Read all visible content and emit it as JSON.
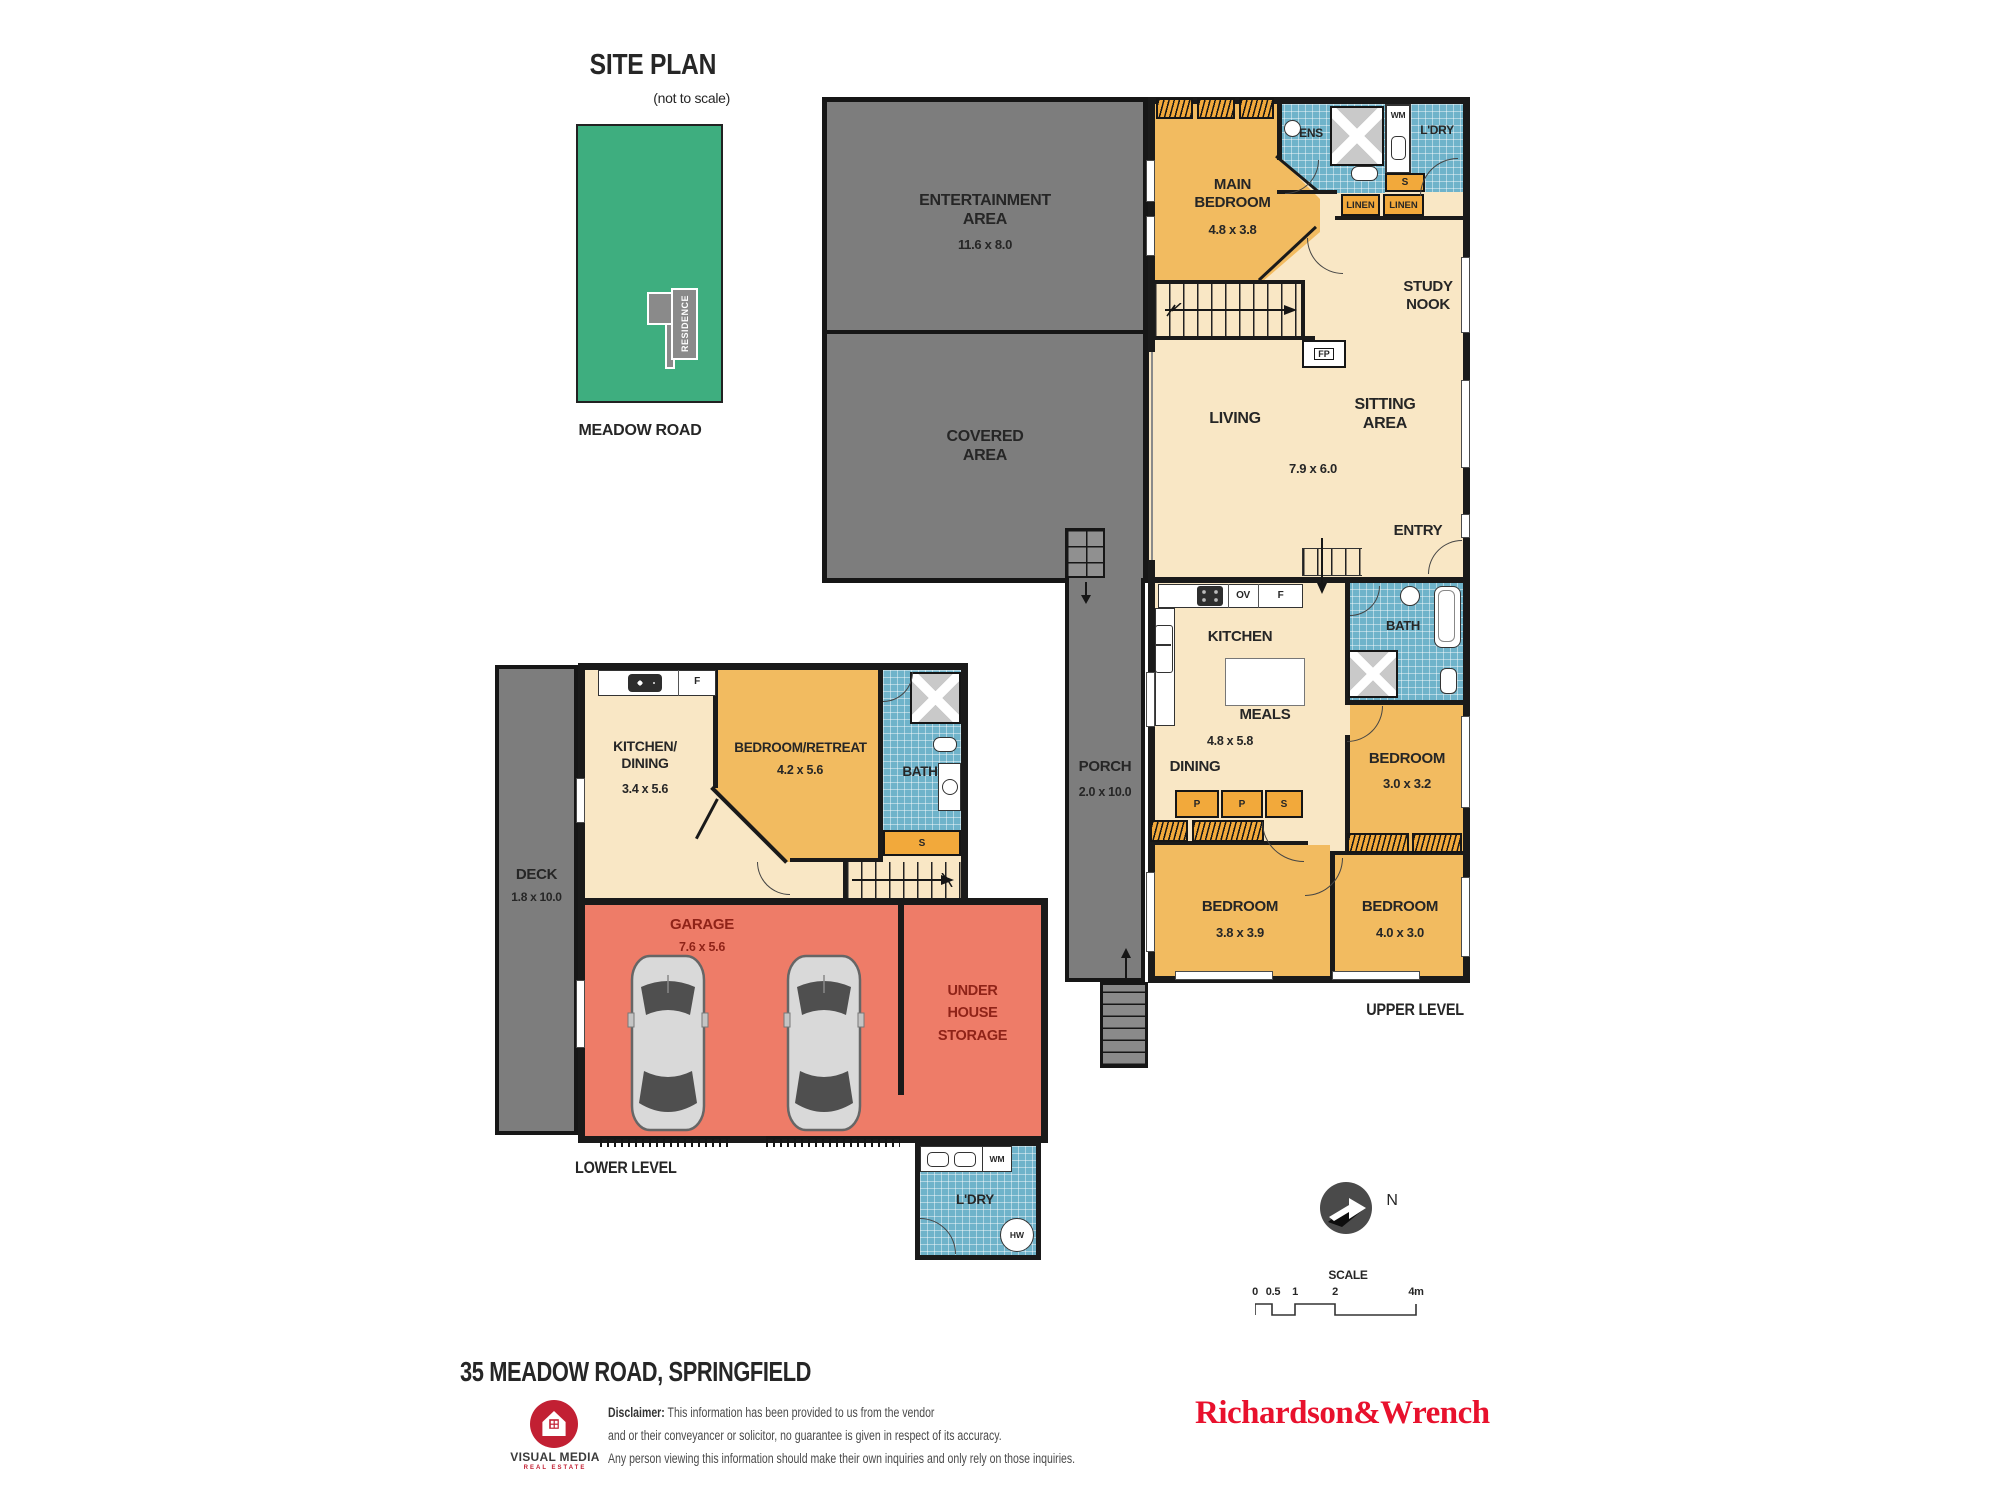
{
  "site_plan": {
    "title": "SITE PLAN",
    "subtitle": "(not to scale)",
    "residence": "RESIDENCE",
    "road": "MEADOW ROAD"
  },
  "upper": {
    "entertainment_name": "ENTERTAINMENT AREA",
    "entertainment_dims": "11.6 x 8.0",
    "covered_name": "COVERED AREA",
    "porch_name": "PORCH",
    "porch_dims": "2.0 x 10.0",
    "main_bedroom_name": "MAIN BEDROOM",
    "main_bedroom_dims": "4.8 x 3.8",
    "ens": "ENS",
    "wm": "WM",
    "ldry": "L'DRY",
    "store_s": "S",
    "linen": [
      "LINEN",
      "LINEN"
    ],
    "study_nook": "STUDY NOOK",
    "fireplace": "FP",
    "living": "LIVING",
    "sitting": "SITTING AREA",
    "living_dims": "7.9 x 6.0",
    "entry": "ENTRY",
    "kitchen": "KITCHEN",
    "oven": "OV",
    "fridge": "F",
    "meals": "MEALS",
    "meals_dims": "4.8 x 5.8",
    "dining": "DINING",
    "pantry": [
      "P",
      "P",
      "S"
    ],
    "bath": "BATH",
    "bedroom1_name": "BEDROOM",
    "bedroom1_dims": "3.0 x 3.2",
    "bedroom2_name": "BEDROOM",
    "bedroom2_dims": "3.8 x 3.9",
    "bedroom3_name": "BEDROOM",
    "bedroom3_dims": "4.0 x 3.0",
    "level": "UPPER LEVEL"
  },
  "lower": {
    "deck_name": "DECK",
    "deck_dims": "1.8 x 10.0",
    "kitchen_name": "KITCHEN/ DINING",
    "kitchen_dims": "3.4 x 5.6",
    "fridge": "F",
    "retreat_name": "BEDROOM/RETREAT",
    "retreat_dims": "4.2 x 5.6",
    "bath": "BATH",
    "store_s": "S",
    "garage_name": "GARAGE",
    "garage_dims": "7.6 x 5.6",
    "storage_name": "UNDER HOUSE STORAGE",
    "ldry": "L'DRY",
    "wm": "WM",
    "hw": "HW",
    "level": "LOWER LEVEL"
  },
  "compass_label": "N",
  "scale_bar": {
    "title": "SCALE",
    "ticks": [
      "0",
      "0.5",
      "1",
      "2",
      "4m"
    ]
  },
  "footer": {
    "address": "35 MEADOW ROAD, SPRINGFIELD",
    "logo_name": "VISUAL MEDIA",
    "logo_tagline": "REAL ESTATE",
    "disclaimer_label": "Disclaimer:",
    "disclaimer_lines": [
      "This information has been provided to us from the vendor",
      "and or their conveyancer or solicitor, no guarantee is given in respect of its accuracy.",
      "Any person viewing this information should make their own inquiries and only rely on those inquiries."
    ],
    "agency": "Richardson&Wrench"
  },
  "colors": {
    "room_cream": "#F9E7C5",
    "room_orange": "#F2BB60",
    "cabinet_orange": "#F2A93B",
    "tile_blue": "#6FB3CA",
    "area_gray": "#7D7D7D",
    "garage_red": "#EE7C68",
    "site_green": "#3EAE7F",
    "wall_black": "#1A1A1A",
    "agency_red": "#E8112D",
    "logo_red": "#C22033"
  }
}
